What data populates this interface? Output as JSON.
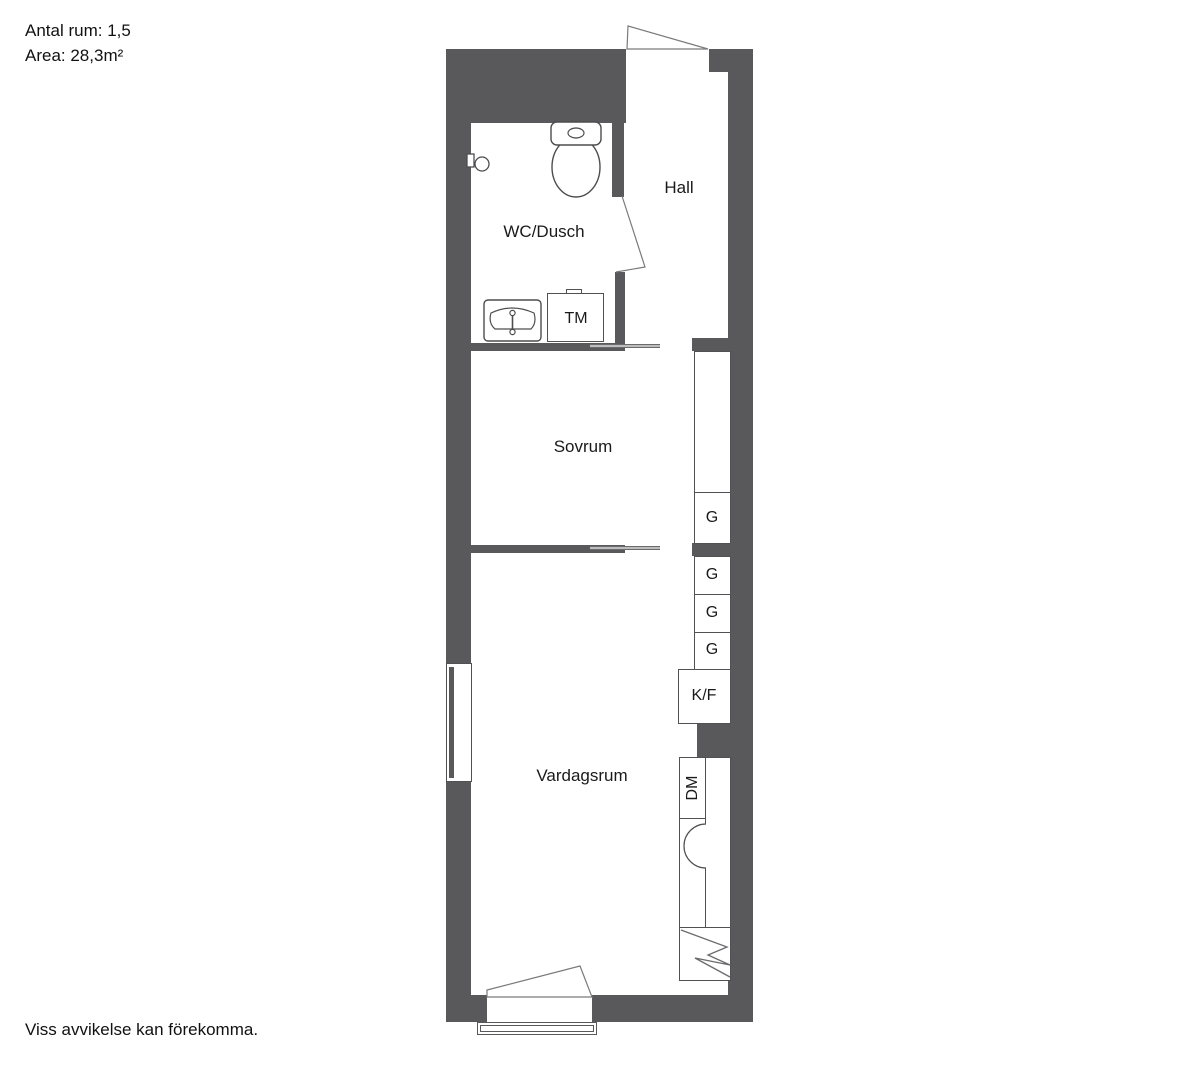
{
  "meta": {
    "rooms_count_label": "Antal rum: 1,5",
    "area_label": "Area: 28,3m²",
    "disclaimer": "Viss avvikelse kan förekomma."
  },
  "rooms": {
    "hall": "Hall",
    "wc": "WC/Dusch",
    "bedroom": "Sovrum",
    "living": "Vardagsrum"
  },
  "fixtures": {
    "washing_machine": "TM",
    "fridge_freezer": "K/F",
    "dishwasher": "DM",
    "g": [
      "G",
      "G",
      "G",
      "G"
    ]
  },
  "symbols": [
    "toilet-icon",
    "sink-icon",
    "shower-mixer-icon",
    "stove-icon",
    "door-swing",
    "sliding-door",
    "window",
    "balcony-railing"
  ],
  "colors": {
    "wall": "#59595b",
    "line": "#515153",
    "slider": "#bdbdbd",
    "text": "#1a1a1a"
  }
}
